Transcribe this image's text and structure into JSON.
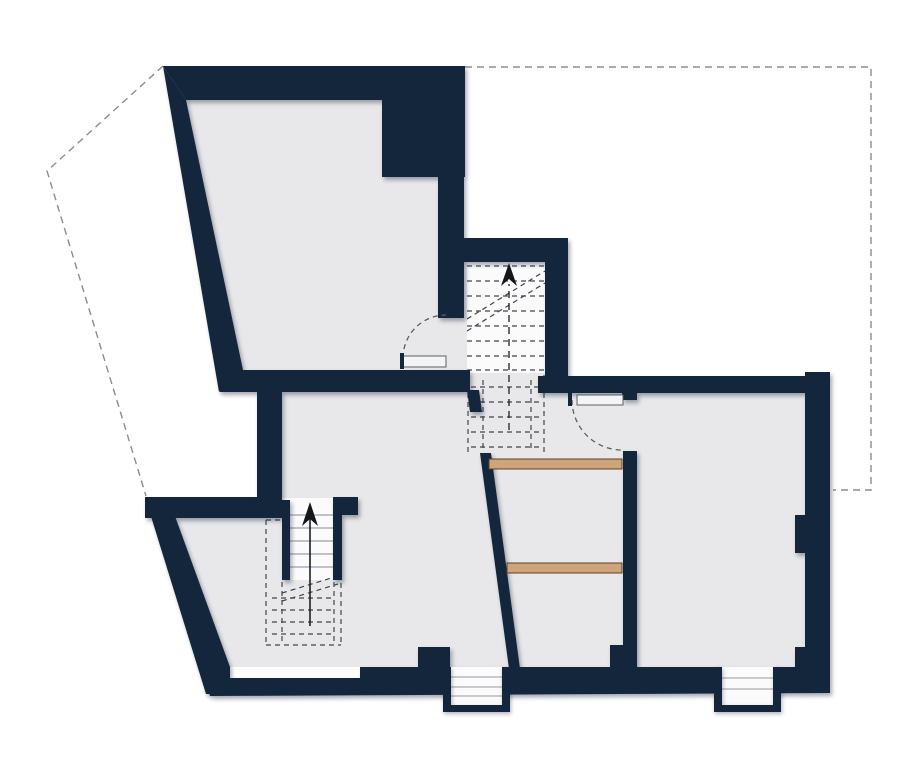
{
  "canvas": {
    "width": 920,
    "height": 764,
    "background": "#ffffff"
  },
  "palette": {
    "wall": "#13263c",
    "floor": "#e8e8ea",
    "stairWhite": "#fbfbfc",
    "treadLine": "#9aa1ab",
    "stepLine": "#a9adb3",
    "dashDark": "#41464d",
    "dashRoof": "#8d8d8d",
    "walkLine": "#1c1f24",
    "wood": "#cfa478",
    "woodEdge": "#55432a",
    "doorFill": "#f4f4f4",
    "doorEdge": "#5a5f66",
    "arrow": "#14161a",
    "none": "none"
  },
  "features": [
    {
      "name": "roof-outline-left",
      "layer": "roof-outline-layer",
      "type": "polyline",
      "pts": [
        [
          163,
          66
        ],
        [
          47,
          171
        ],
        [
          146,
          496
        ]
      ],
      "stroke": "dashRoof",
      "sw": 1.4,
      "dash": "7 5"
    },
    {
      "name": "roof-outline-right",
      "layer": "roof-outline-layer",
      "type": "polyline",
      "pts": [
        [
          465,
          67
        ],
        [
          871,
          67
        ],
        [
          871,
          490
        ],
        [
          833,
          490
        ]
      ],
      "stroke": "dashRoof",
      "sw": 1.4,
      "dash": "7 5"
    },
    {
      "name": "room-a-floor",
      "layer": "floor-layer",
      "type": "polygon",
      "pts": [
        [
          186,
          100
        ],
        [
          382,
          100
        ],
        [
          382,
          177
        ],
        [
          438,
          177
        ],
        [
          438,
          318
        ],
        [
          467,
          318
        ],
        [
          467,
          372
        ],
        [
          243,
          372
        ]
      ],
      "fill": "floor"
    },
    {
      "name": "stair-shaft-floor",
      "layer": "floor-layer",
      "type": "rect",
      "r": [
        438,
        262,
        107,
        130
      ],
      "fill": "floor"
    },
    {
      "name": "lower-level-floor",
      "layer": "floor-layer",
      "type": "polygon",
      "pts": [
        [
          257,
          392
        ],
        [
          807,
          392
        ],
        [
          807,
          667
        ],
        [
          229,
          667
        ],
        [
          167,
          518
        ],
        [
          257,
          518
        ]
      ],
      "fill": "floor"
    },
    {
      "name": "upper-stair-tread-area",
      "layer": "stair-detail-layer",
      "type": "rect",
      "r": [
        467,
        262,
        78,
        111
      ],
      "fill": "stairWhite"
    },
    {
      "name": "upper-stair-treads",
      "layer": "stair-detail-layer",
      "type": "lines",
      "segs": [
        [
          467,
          266,
          545,
          266
        ],
        [
          467,
          281,
          545,
          281
        ],
        [
          467,
          296,
          545,
          296
        ],
        [
          467,
          311,
          545,
          311
        ],
        [
          467,
          326,
          545,
          326
        ],
        [
          467,
          341,
          545,
          341
        ],
        [
          467,
          356,
          545,
          356
        ],
        [
          467,
          370,
          545,
          370
        ]
      ],
      "stroke": "dashDark",
      "sw": 1.2,
      "dash": "5 4"
    },
    {
      "name": "upper-stair-break-lines",
      "layer": "stair-detail-layer",
      "type": "lines",
      "segs": [
        [
          467,
          331,
          545,
          283
        ],
        [
          467,
          319,
          545,
          271
        ]
      ],
      "stroke": "dashDark",
      "sw": 1.2,
      "dash": "5 4"
    },
    {
      "name": "upper-stair-below-cut-outline",
      "layer": "stair-detail-layer",
      "type": "lines",
      "segs": [
        [
          468,
          375,
          468,
          453
        ],
        [
          544,
          375,
          544,
          453
        ],
        [
          483,
          380,
          483,
          450
        ],
        [
          531,
          380,
          531,
          450
        ]
      ],
      "stroke": "dashDark",
      "sw": 1.2,
      "dash": "5 4"
    },
    {
      "name": "upper-stair-below-cut-treads",
      "layer": "stair-detail-layer",
      "type": "lines",
      "segs": [
        [
          471,
          387,
          541,
          387
        ],
        [
          471,
          402,
          541,
          402
        ],
        [
          471,
          417,
          541,
          417
        ],
        [
          471,
          432,
          541,
          432
        ],
        [
          471,
          447,
          541,
          447
        ]
      ],
      "stroke": "dashDark",
      "sw": 1.2,
      "dash": "5 4"
    },
    {
      "name": "lower-stair-landing",
      "layer": "stair-detail-layer",
      "type": "rect",
      "r": [
        282,
        498,
        51,
        82
      ],
      "fill": "stairWhite"
    },
    {
      "name": "lower-stair-treads",
      "layer": "stair-detail-layer",
      "type": "lines",
      "segs": [
        [
          290,
          515,
          333,
          515
        ],
        [
          290,
          528,
          333,
          528
        ],
        [
          290,
          541,
          333,
          541
        ],
        [
          290,
          554,
          333,
          554
        ],
        [
          290,
          567,
          333,
          567
        ]
      ],
      "stroke": "treadLine",
      "sw": 1.3
    },
    {
      "name": "lower-stair-dashed-box",
      "layer": "stair-detail-layer",
      "type": "lines",
      "segs": [
        [
          266,
          520,
          281,
          520
        ],
        [
          334,
          520,
          341,
          520
        ],
        [
          266,
          520,
          266,
          645
        ],
        [
          341,
          520,
          341,
          645
        ],
        [
          266,
          645,
          341,
          645
        ],
        [
          282,
          582,
          282,
          645
        ],
        [
          334,
          582,
          334,
          645
        ]
      ],
      "stroke": "dashDark",
      "sw": 1.2,
      "dash": "5 4"
    },
    {
      "name": "lower-stair-dashed-treads",
      "layer": "stair-detail-layer",
      "type": "lines",
      "segs": [
        [
          272,
          598,
          335,
          598
        ],
        [
          272,
          610,
          335,
          610
        ],
        [
          272,
          622,
          335,
          622
        ],
        [
          272,
          634,
          335,
          634
        ]
      ],
      "stroke": "dashDark",
      "sw": 1.2,
      "dash": "5 4"
    },
    {
      "name": "lower-stair-break-lines",
      "layer": "stair-detail-layer",
      "type": "lines",
      "segs": [
        [
          282,
          601,
          338,
          584
        ],
        [
          282,
          593,
          338,
          576
        ]
      ],
      "stroke": "dashDark",
      "sw": 1.2,
      "dash": "5 4"
    },
    {
      "name": "wall-top-outer",
      "layer": "wall-layer",
      "type": "polygon",
      "pts": [
        [
          163,
          66
        ],
        [
          465,
          66
        ],
        [
          465,
          100
        ],
        [
          186,
          100
        ]
      ],
      "fill": "wall"
    },
    {
      "name": "wall-left-slanted",
      "layer": "wall-layer",
      "type": "polygon",
      "pts": [
        [
          163,
          66
        ],
        [
          186,
          100
        ],
        [
          243,
          370
        ],
        [
          219,
          392
        ]
      ],
      "fill": "wall"
    },
    {
      "name": "wall-ne-block",
      "layer": "wall-layer",
      "type": "rect",
      "r": [
        382,
        66,
        83,
        111
      ],
      "fill": "wall"
    },
    {
      "name": "wall-shaft-west",
      "layer": "wall-layer",
      "type": "rect",
      "r": [
        438,
        177,
        26,
        141
      ],
      "fill": "wall"
    },
    {
      "name": "wall-shaft-north",
      "layer": "wall-layer",
      "type": "rect",
      "r": [
        463,
        238,
        105,
        24
      ],
      "fill": "wall"
    },
    {
      "name": "wall-shaft-east",
      "layer": "wall-layer",
      "type": "rect",
      "r": [
        545,
        240,
        23,
        137
      ],
      "fill": "wall"
    },
    {
      "name": "wall-room-a-south",
      "layer": "wall-layer",
      "type": "rect",
      "r": [
        220,
        370,
        250,
        22
      ],
      "fill": "wall"
    },
    {
      "name": "wall-main-south",
      "layer": "wall-layer",
      "type": "rect",
      "r": [
        538,
        376,
        292,
        17
      ],
      "fill": "wall"
    },
    {
      "name": "wall-door-jamb",
      "layer": "wall-layer",
      "type": "rect",
      "r": [
        622,
        388,
        15,
        12
      ],
      "fill": "wall"
    },
    {
      "name": "wall-east",
      "layer": "wall-layer",
      "type": "rect",
      "r": [
        805,
        372,
        25,
        321
      ],
      "fill": "wall"
    },
    {
      "name": "wall-east-pier",
      "layer": "wall-layer",
      "type": "rect",
      "r": [
        795,
        515,
        10,
        38
      ],
      "fill": "wall"
    },
    {
      "name": "wall-se-corner",
      "layer": "wall-layer",
      "type": "rect",
      "r": [
        795,
        647,
        35,
        46
      ],
      "fill": "wall"
    },
    {
      "name": "wall-bottom",
      "layer": "wall-layer",
      "type": "polygon",
      "pts": [
        [
          205,
          678
        ],
        [
          360,
          678
        ],
        [
          360,
          667
        ],
        [
          830,
          667
        ],
        [
          830,
          693
        ],
        [
          210,
          696
        ]
      ],
      "fill": "wall"
    },
    {
      "name": "wall-entry-pier",
      "layer": "wall-layer",
      "type": "rect",
      "r": [
        418,
        647,
        32,
        21
      ],
      "fill": "wall"
    },
    {
      "name": "wall-sw-slant",
      "layer": "wall-layer",
      "type": "polygon",
      "pts": [
        [
          145,
          497
        ],
        [
          168,
          497
        ],
        [
          230,
          667
        ],
        [
          230,
          694
        ],
        [
          206,
          694
        ]
      ],
      "fill": "wall"
    },
    {
      "name": "wall-west-lower",
      "layer": "wall-layer",
      "type": "rect",
      "r": [
        145,
        497,
        137,
        21
      ],
      "fill": "wall"
    },
    {
      "name": "wall-west-mid",
      "layer": "wall-layer",
      "type": "rect",
      "r": [
        257,
        392,
        25,
        126
      ],
      "fill": "wall"
    },
    {
      "name": "wall-stair-stub",
      "layer": "wall-layer",
      "type": "rect",
      "r": [
        333,
        497,
        25,
        18
      ],
      "fill": "wall"
    },
    {
      "name": "wall-stair-west",
      "layer": "wall-layer",
      "type": "rect",
      "r": [
        282,
        500,
        8,
        80
      ],
      "fill": "wall"
    },
    {
      "name": "wall-stair-east",
      "layer": "wall-layer",
      "type": "rect",
      "r": [
        333,
        515,
        9,
        65
      ],
      "fill": "wall"
    },
    {
      "name": "wall-closet-stub",
      "layer": "wall-layer",
      "type": "polygon",
      "pts": [
        [
          467,
          390
        ],
        [
          479,
          390
        ],
        [
          482,
          412
        ],
        [
          470,
          412
        ]
      ],
      "fill": "wall"
    },
    {
      "name": "wall-closet-slant",
      "layer": "wall-layer",
      "type": "polygon",
      "pts": [
        [
          480,
          453
        ],
        [
          491,
          453
        ],
        [
          523,
          691
        ],
        [
          512,
          691
        ]
      ],
      "fill": "wall"
    },
    {
      "name": "wall-partition",
      "layer": "wall-layer",
      "type": "rect",
      "r": [
        623,
        451,
        14,
        217
      ],
      "fill": "wall"
    },
    {
      "name": "wall-partition-foot",
      "layer": "wall-layer",
      "type": "rect",
      "r": [
        610,
        645,
        27,
        23
      ],
      "fill": "wall"
    },
    {
      "name": "entry-steps-center-white",
      "layer": "exterior-steps-layer",
      "type": "rect",
      "r": [
        451,
        667,
        51,
        38
      ],
      "fill": "stairWhite"
    },
    {
      "name": "entry-steps-center-treads",
      "layer": "exterior-steps-layer",
      "type": "lines",
      "segs": [
        [
          451,
          677,
          502,
          677
        ],
        [
          451,
          687,
          502,
          687
        ],
        [
          451,
          696,
          502,
          696
        ]
      ],
      "stroke": "stepLine",
      "sw": 1.2
    },
    {
      "name": "entry-steps-center-frame-left",
      "layer": "frame-layer",
      "type": "rect",
      "r": [
        443,
        667,
        8,
        45
      ],
      "fill": "wall"
    },
    {
      "name": "entry-steps-center-frame-right",
      "layer": "frame-layer",
      "type": "rect",
      "r": [
        502,
        667,
        8,
        45
      ],
      "fill": "wall"
    },
    {
      "name": "entry-steps-center-frame-bottom",
      "layer": "frame-layer",
      "type": "rect",
      "r": [
        443,
        705,
        67,
        7
      ],
      "fill": "wall"
    },
    {
      "name": "entry-steps-right-white",
      "layer": "exterior-steps-layer",
      "type": "rect",
      "r": [
        722,
        667,
        51,
        38
      ],
      "fill": "stairWhite"
    },
    {
      "name": "entry-steps-right-treads",
      "layer": "exterior-steps-layer",
      "type": "lines",
      "segs": [
        [
          722,
          678,
          773,
          678
        ],
        [
          722,
          689,
          773,
          689
        ]
      ],
      "stroke": "stepLine",
      "sw": 1.2
    },
    {
      "name": "entry-steps-right-frame-left",
      "layer": "frame-layer",
      "type": "rect",
      "r": [
        714,
        667,
        8,
        45
      ],
      "fill": "wall"
    },
    {
      "name": "entry-steps-right-frame-right",
      "layer": "frame-layer",
      "type": "rect",
      "r": [
        773,
        667,
        8,
        45
      ],
      "fill": "wall"
    },
    {
      "name": "entry-steps-right-frame-bottom",
      "layer": "frame-layer",
      "type": "rect",
      "r": [
        714,
        705,
        67,
        7
      ],
      "fill": "wall"
    },
    {
      "name": "closet-shelf-upper",
      "layer": "furniture-layer",
      "type": "rect",
      "r": [
        489,
        459,
        133,
        10
      ],
      "fill": "wood",
      "stroke": "woodEdge",
      "sw": 1
    },
    {
      "name": "closet-shelf-lower",
      "layer": "furniture-layer",
      "type": "rect",
      "r": [
        507,
        563,
        115,
        10
      ],
      "fill": "wood",
      "stroke": "woodEdge",
      "sw": 1
    },
    {
      "name": "door-room-a-swing-arc",
      "layer": "door-layer",
      "type": "path",
      "d": "M403,358 A43 43 0 0 1 446,315",
      "stroke": "doorEdge",
      "sw": 1.3,
      "dash": "5 4",
      "fill": "none"
    },
    {
      "name": "door-room-a-leaf",
      "layer": "door-layer",
      "type": "rect",
      "r": [
        403,
        356,
        43,
        11
      ],
      "fill": "doorFill",
      "stroke": "doorEdge",
      "sw": 1
    },
    {
      "name": "door-room-a-hinge-tick",
      "layer": "door-layer",
      "type": "rect",
      "r": [
        400,
        353,
        4,
        16
      ],
      "fill": "wall"
    },
    {
      "name": "door-main-room-swing-arc",
      "layer": "door-layer",
      "type": "path",
      "d": "M572,400 A50 50 0 0 0 622,450",
      "stroke": "doorEdge",
      "sw": 1.3,
      "dash": "5 4",
      "fill": "none"
    },
    {
      "name": "door-main-room-leaf",
      "layer": "door-layer",
      "type": "rect",
      "r": [
        577,
        395,
        46,
        10
      ],
      "fill": "doorFill",
      "stroke": "doorEdge",
      "sw": 1
    },
    {
      "name": "door-main-room-hinge-tick",
      "layer": "door-layer",
      "type": "rect",
      "r": [
        568,
        390,
        4,
        16
      ],
      "fill": "wall"
    },
    {
      "name": "upper-stair-direction-line",
      "layer": "annotation-layer",
      "type": "line",
      "seg": [
        509,
        430,
        509,
        284
      ],
      "stroke": "walkLine",
      "sw": 1.3,
      "dash": "7 5"
    },
    {
      "name": "upper-stair-direction-arrowhead",
      "layer": "annotation-layer",
      "type": "polygon",
      "pts": [
        [
          509,
          263
        ],
        [
          501,
          286
        ],
        [
          509,
          279
        ],
        [
          517,
          286
        ]
      ],
      "fill": "arrow"
    },
    {
      "name": "lower-stair-direction-line",
      "layer": "annotation-layer",
      "type": "line",
      "seg": [
        310,
        626,
        310,
        516
      ],
      "stroke": "walkLine",
      "sw": 1.6
    },
    {
      "name": "lower-stair-direction-arrowhead",
      "layer": "annotation-layer",
      "type": "polygon",
      "pts": [
        [
          310,
          502
        ],
        [
          302,
          526
        ],
        [
          310,
          519
        ],
        [
          318,
          526
        ]
      ],
      "fill": "arrow"
    }
  ]
}
